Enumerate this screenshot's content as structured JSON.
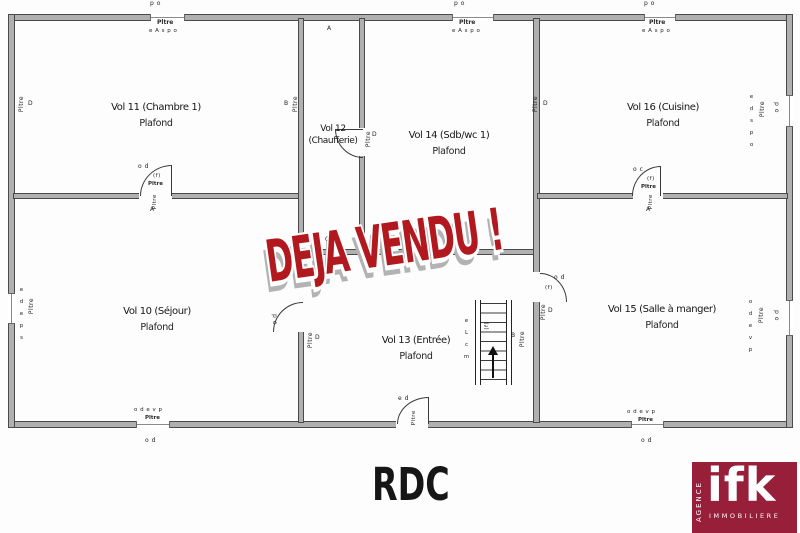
{
  "floor": {
    "title": "RDC"
  },
  "stamp": {
    "text": "DEJA VENDU !"
  },
  "logo": {
    "brand": "ifk",
    "vertical": "AGENCE",
    "bottom": "IMMOBILIERE"
  },
  "rooms": {
    "vol11": {
      "name": "Vol 11 (Chambre 1)",
      "sub": "Plafond"
    },
    "vol12": {
      "line1": "Vol 12",
      "line2": "(Chaufferie)"
    },
    "vol14": {
      "name": "Vol 14 (Sdb/wc 1)",
      "sub": "Plafond"
    },
    "vol16": {
      "name": "Vol 16 (Cuisine)",
      "sub": "Plafond"
    },
    "vol10": {
      "name": "Vol 10 (Séjour)",
      "sub": "Plafond"
    },
    "vol13": {
      "name": "Vol 13 (Entrée)",
      "sub": "Plafond"
    },
    "vol15": {
      "name": "Vol 15 (Salle à manger)",
      "sub": "Plafond"
    }
  },
  "tiny": {
    "po": "p o",
    "od": "o d",
    "ed": "e d",
    "oc": "o c",
    "a": "A",
    "b": "B",
    "c": "C",
    "d": "D",
    "f": "(f)",
    "pltre": "Pltre",
    "easpo": "e A s p o",
    "odevp": "o d e v p",
    "edspo": "e d s p o",
    "edeps": "e d e p s",
    "stair_letters": "e L c m"
  },
  "colors": {
    "stamp_red": "#b2191f",
    "logo_maroon": "#981f3a",
    "wall_gray": "#b0b0b0"
  }
}
